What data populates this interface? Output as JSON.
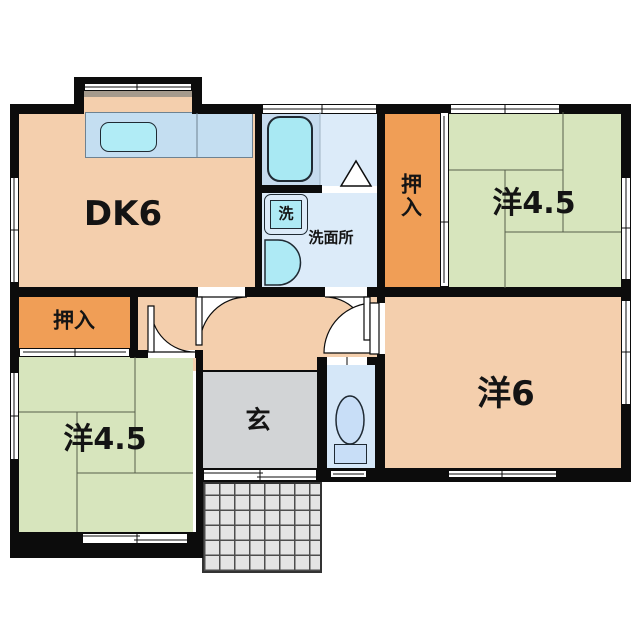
{
  "plan_title": "floor-plan",
  "palette": {
    "wall": "#0c0c0c",
    "wood_floor": "#f4cfad",
    "tatami_green": "#d7e5bd",
    "closet_orange": "#f09e56",
    "wet_blue": "#dcebf9",
    "bath_zone": "#c6dbee",
    "fixture_cyan": "#aeeaf5",
    "toilet_blue": "#d5e7f8",
    "genkan_gray": "#d2d4d6",
    "porch_gray": "#e4e4e4",
    "line": "#0c0c0c"
  },
  "rects": [
    {
      "id": "kitchen-bay-floor",
      "x": 84,
      "y": 91,
      "w": 108,
      "h": 21,
      "f": "#f4cfad"
    },
    {
      "id": "kitchen-bay-shelf",
      "x": 84,
      "y": 91,
      "w": 108,
      "h": 6,
      "f": "#a59a8c"
    },
    {
      "id": "room-dk-floor",
      "x": 19,
      "y": 112,
      "w": 236,
      "h": 175,
      "f": "#f4cfad"
    },
    {
      "id": "hallway-floor",
      "x": 138,
      "y": 297,
      "w": 239,
      "h": 74,
      "f": "#f4cfad"
    },
    {
      "id": "room-yo6-floor",
      "x": 385,
      "y": 297,
      "w": 236,
      "h": 171,
      "f": "#f4cfad"
    },
    {
      "id": "room-yo45-top-right-floor",
      "x": 449,
      "y": 112,
      "w": 172,
      "h": 176,
      "f": "#d7e5bd"
    },
    {
      "id": "room-yo45-bottom-left-floor",
      "x": 19,
      "y": 357,
      "w": 174,
      "h": 175,
      "f": "#d7e5bd"
    },
    {
      "id": "closet-top-right-floor",
      "x": 385,
      "y": 112,
      "w": 55,
      "h": 175,
      "f": "#f09e56"
    },
    {
      "id": "closet-bottom-left-floor",
      "x": 19,
      "y": 297,
      "w": 111,
      "h": 51,
      "f": "#f09e56"
    },
    {
      "id": "bathroom-floor",
      "x": 262,
      "y": 112,
      "w": 115,
      "h": 74,
      "f": "#dcebf9"
    },
    {
      "id": "bathtub-zone",
      "x": 262,
      "y": 112,
      "w": 58,
      "h": 74,
      "f": "#c6dbee"
    },
    {
      "id": "washroom-floor",
      "x": 262,
      "y": 193,
      "w": 115,
      "h": 94,
      "f": "#dcebf9"
    },
    {
      "id": "toilet-room-floor",
      "x": 327,
      "y": 357,
      "w": 48,
      "h": 111,
      "f": "#d5e7f8"
    },
    {
      "id": "genkan-floor",
      "x": 203,
      "y": 371,
      "w": 114,
      "h": 97,
      "f": "#d2d4d6"
    },
    {
      "id": "porch-tiles",
      "x": 202,
      "y": 482,
      "w": 120,
      "h": 91,
      "f": "#e4e4e4",
      "grid": 15
    },
    {
      "id": "kitchen-counter",
      "x": 85,
      "y": 112,
      "w": 168,
      "h": 46,
      "f": "#c4def1",
      "b": "1px solid #6e8291"
    },
    {
      "id": "kitchen-sink",
      "x": 100,
      "y": 122,
      "w": 57,
      "h": 30,
      "r": 9,
      "f": "#b1ecf6",
      "b": "1.5px solid #1f2a33"
    },
    {
      "id": "bathtub",
      "x": 267,
      "y": 116,
      "w": 46,
      "h": 66,
      "r": 13,
      "f": "#a9e9f3",
      "b": "2px solid #1f2a33"
    },
    {
      "id": "washing-machine",
      "x": 264,
      "y": 194,
      "w": 44,
      "h": 41,
      "r": 7,
      "f": "#dcebf9",
      "b": "1.5px solid #1f2a33"
    },
    {
      "id": "washing-machine-tub",
      "x": 270,
      "y": 200,
      "w": 32,
      "h": 29,
      "f": "#aeeaf5",
      "b": "1.5px solid #1f2a33"
    },
    {
      "id": "toilet-tank",
      "x": 334,
      "y": 444,
      "w": 33,
      "h": 20,
      "f": "#c8def7",
      "b": "1.5px solid #1f2a33"
    },
    {
      "id": "wall-top-left",
      "x": 10,
      "y": 104,
      "w": 74,
      "h": 10,
      "f": "#0c0c0c"
    },
    {
      "id": "wall-top-right",
      "x": 192,
      "y": 104,
      "w": 439,
      "h": 10,
      "f": "#0c0c0c"
    },
    {
      "id": "wall-bay-top",
      "x": 74,
      "y": 77,
      "w": 128,
      "h": 8,
      "f": "#0c0c0c"
    },
    {
      "id": "wall-bay-left",
      "x": 74,
      "y": 77,
      "w": 10,
      "h": 37,
      "f": "#0c0c0c"
    },
    {
      "id": "wall-bay-right",
      "x": 192,
      "y": 77,
      "w": 10,
      "h": 37,
      "f": "#0c0c0c"
    },
    {
      "id": "wall-left",
      "x": 10,
      "y": 104,
      "w": 9,
      "h": 454,
      "f": "#0c0c0c"
    },
    {
      "id": "wall-right",
      "x": 621,
      "y": 104,
      "w": 10,
      "h": 378,
      "f": "#0c0c0c"
    },
    {
      "id": "wall-bottom-left",
      "x": 10,
      "y": 532,
      "w": 193,
      "h": 26,
      "f": "#0c0c0c"
    },
    {
      "id": "wall-bottom-right",
      "x": 196,
      "y": 468,
      "w": 435,
      "h": 14,
      "f": "#0c0c0c"
    },
    {
      "id": "wall-porch-side",
      "x": 196,
      "y": 352,
      "w": 7,
      "h": 206,
      "f": "#0c0c0c"
    },
    {
      "id": "wall-dk-bath",
      "x": 255,
      "y": 104,
      "w": 7,
      "h": 193,
      "f": "#0c0c0c"
    },
    {
      "id": "wall-bath-washroom",
      "x": 255,
      "y": 185,
      "w": 67,
      "h": 8,
      "f": "#0c0c0c"
    },
    {
      "id": "wall-bath-closet",
      "x": 377,
      "y": 104,
      "w": 8,
      "h": 193,
      "f": "#0c0c0c"
    },
    {
      "id": "wall-mid-band",
      "x": 10,
      "y": 287,
      "w": 621,
      "h": 10,
      "f": "#0c0c0c"
    },
    {
      "id": "wall-hall-left",
      "x": 130,
      "y": 287,
      "w": 8,
      "h": 65,
      "f": "#0c0c0c"
    },
    {
      "id": "wall-hall-bottom",
      "x": 130,
      "y": 350,
      "w": 73,
      "h": 8,
      "f": "#0c0c0c"
    },
    {
      "id": "wall-toilet-left",
      "x": 317,
      "y": 357,
      "w": 10,
      "h": 111,
      "f": "#0c0c0c"
    },
    {
      "id": "wall-toilet-top",
      "x": 317,
      "y": 357,
      "w": 68,
      "h": 8,
      "f": "#0c0c0c"
    },
    {
      "id": "wall-yo6-left-upper",
      "x": 377,
      "y": 297,
      "w": 8,
      "h": 60,
      "f": "#0c0c0c"
    },
    {
      "id": "wall-yo6-left-lower",
      "x": 375,
      "y": 357,
      "w": 10,
      "h": 111,
      "f": "#0c0c0c"
    },
    {
      "id": "window-bay",
      "x": 84,
      "y": 83,
      "w": 108,
      "h": 8,
      "f": "#ffffff",
      "b": "1px solid #0c0c0c"
    },
    {
      "id": "window-top-bathroom",
      "x": 262,
      "y": 104,
      "w": 115,
      "h": 10,
      "f": "#ffffff",
      "b": "1px solid #0c0c0c"
    },
    {
      "id": "window-top-yo45",
      "x": 450,
      "y": 104,
      "w": 110,
      "h": 10,
      "f": "#ffffff",
      "b": "1px solid #0c0c0c"
    },
    {
      "id": "window-left-dk",
      "x": 10,
      "y": 177,
      "w": 9,
      "h": 106,
      "f": "#ffffff",
      "b": "1px solid #0c0c0c"
    },
    {
      "id": "window-left-yo45",
      "x": 10,
      "y": 372,
      "w": 9,
      "h": 88,
      "f": "#ffffff",
      "b": "1px solid #0c0c0c"
    },
    {
      "id": "window-right-yo45",
      "x": 621,
      "y": 177,
      "w": 10,
      "h": 103,
      "f": "#ffffff",
      "b": "1px solid #0c0c0c"
    },
    {
      "id": "window-right-yo6",
      "x": 621,
      "y": 300,
      "w": 10,
      "h": 105,
      "f": "#ffffff",
      "b": "1px solid #0c0c0c"
    },
    {
      "id": "window-bottom-yo45",
      "x": 82,
      "y": 533,
      "w": 106,
      "h": 11,
      "f": "#ffffff",
      "b": "1px solid #0c0c0c"
    },
    {
      "id": "entrance-door",
      "x": 203,
      "y": 469,
      "w": 114,
      "h": 12,
      "f": "#ffffff",
      "b": "1px solid #0c0c0c"
    },
    {
      "id": "window-bottom-toilet",
      "x": 330,
      "y": 470,
      "w": 37,
      "h": 8,
      "f": "#ffffff",
      "b": "1px solid #0c0c0c"
    },
    {
      "id": "window-bottom-yo6",
      "x": 448,
      "y": 470,
      "w": 109,
      "h": 8,
      "f": "#ffffff",
      "b": "1px solid #0c0c0c"
    },
    {
      "id": "closet-tr-sliding-door",
      "x": 440,
      "y": 112,
      "w": 9,
      "h": 175,
      "f": "#ffffff",
      "b": "1px solid #0c0c0c"
    },
    {
      "id": "closet-bl-sliding-door",
      "x": 19,
      "y": 348,
      "w": 111,
      "h": 9,
      "f": "#ffffff",
      "b": "1px solid #0c0c0c"
    },
    {
      "id": "doorway-dk",
      "x": 198,
      "y": 287,
      "w": 47,
      "h": 10,
      "f": "#ffffff"
    },
    {
      "id": "doorway-washroom",
      "x": 325,
      "y": 287,
      "w": 42,
      "h": 10,
      "f": "#ffffff"
    },
    {
      "id": "doorway-yo45",
      "x": 148,
      "y": 350,
      "w": 47,
      "h": 8,
      "f": "#ffffff"
    },
    {
      "id": "doorway-yo6",
      "x": 377,
      "y": 303,
      "w": 8,
      "h": 51,
      "f": "#ffffff"
    },
    {
      "id": "toilet-door",
      "x": 327,
      "y": 357,
      "w": 40,
      "h": 8,
      "f": "#ffffff"
    },
    {
      "id": "bathroom-door-sill",
      "x": 322,
      "y": 186,
      "w": 55,
      "h": 7,
      "f": "#ffffff"
    }
  ],
  "lines": [
    {
      "id": "tatami-tr-1",
      "x1": 449,
      "y1": 170,
      "x2": 563,
      "y2": 170,
      "c": "#57604b",
      "w": 1
    },
    {
      "id": "tatami-tr-2",
      "x1": 563,
      "y1": 112,
      "x2": 563,
      "y2": 232,
      "c": "#57604b",
      "w": 1
    },
    {
      "id": "tatami-tr-3",
      "x1": 505,
      "y1": 232,
      "x2": 621,
      "y2": 232,
      "c": "#57604b",
      "w": 1
    },
    {
      "id": "tatami-tr-4",
      "x1": 505,
      "y1": 170,
      "x2": 505,
      "y2": 288,
      "c": "#57604b",
      "w": 1
    },
    {
      "id": "tatami-bl-1",
      "x1": 19,
      "y1": 412,
      "x2": 135,
      "y2": 412,
      "c": "#57604b",
      "w": 1
    },
    {
      "id": "tatami-bl-2",
      "x1": 135,
      "y1": 357,
      "x2": 135,
      "y2": 473,
      "c": "#57604b",
      "w": 1
    },
    {
      "id": "tatami-bl-3",
      "x1": 77,
      "y1": 473,
      "x2": 193,
      "y2": 473,
      "c": "#57604b",
      "w": 1
    },
    {
      "id": "tatami-bl-4",
      "x1": 77,
      "y1": 412,
      "x2": 77,
      "y2": 532,
      "c": "#57604b",
      "w": 1
    },
    {
      "id": "window-bay-line",
      "x1": 84,
      "y1": 87,
      "x2": 192,
      "y2": 87,
      "c": "#0c0c0c",
      "w": 1
    },
    {
      "id": "window-bay-tick",
      "x1": 137,
      "y1": 83,
      "x2": 137,
      "y2": 91,
      "c": "#0c0c0c",
      "w": 1
    },
    {
      "id": "window-top-bathroom-line",
      "x1": 262,
      "y1": 109,
      "x2": 377,
      "y2": 109,
      "c": "#0c0c0c",
      "w": 1
    },
    {
      "id": "window-top-bathroom-tick",
      "x1": 322,
      "y1": 104,
      "x2": 322,
      "y2": 114,
      "c": "#0c0c0c",
      "w": 1
    },
    {
      "id": "window-top-yo45-line",
      "x1": 450,
      "y1": 109,
      "x2": 560,
      "y2": 109,
      "c": "#0c0c0c",
      "w": 1
    },
    {
      "id": "window-top-yo45-tick",
      "x1": 505,
      "y1": 104,
      "x2": 505,
      "y2": 114,
      "c": "#0c0c0c",
      "w": 1
    },
    {
      "id": "window-left-dk-line",
      "x1": 14,
      "y1": 177,
      "x2": 14,
      "y2": 283,
      "c": "#0c0c0c",
      "w": 1
    },
    {
      "id": "window-left-dk-tick",
      "x1": 10,
      "y1": 230,
      "x2": 19,
      "y2": 230,
      "c": "#0c0c0c",
      "w": 1
    },
    {
      "id": "window-left-yo45-line",
      "x1": 14,
      "y1": 372,
      "x2": 14,
      "y2": 460,
      "c": "#0c0c0c",
      "w": 1
    },
    {
      "id": "window-left-yo45-tick",
      "x1": 10,
      "y1": 416,
      "x2": 19,
      "y2": 416,
      "c": "#0c0c0c",
      "w": 1
    },
    {
      "id": "window-right-yo45-line",
      "x1": 626,
      "y1": 177,
      "x2": 626,
      "y2": 280,
      "c": "#0c0c0c",
      "w": 1
    },
    {
      "id": "window-right-yo45-tick",
      "x1": 621,
      "y1": 228,
      "x2": 631,
      "y2": 228,
      "c": "#0c0c0c",
      "w": 1
    },
    {
      "id": "window-right-yo6-line",
      "x1": 626,
      "y1": 300,
      "x2": 626,
      "y2": 405,
      "c": "#0c0c0c",
      "w": 1
    },
    {
      "id": "window-right-yo6-tick",
      "x1": 621,
      "y1": 352,
      "x2": 631,
      "y2": 352,
      "c": "#0c0c0c",
      "w": 1
    },
    {
      "id": "window-bottom-yo45-line-a",
      "x1": 82,
      "y1": 536,
      "x2": 140,
      "y2": 536,
      "c": "#0c0c0c",
      "w": 1
    },
    {
      "id": "window-bottom-yo45-line-b",
      "x1": 134,
      "y1": 540,
      "x2": 188,
      "y2": 540,
      "c": "#0c0c0c",
      "w": 1
    },
    {
      "id": "window-bottom-yo45-tick",
      "x1": 137,
      "y1": 533,
      "x2": 137,
      "y2": 544,
      "c": "#0c0c0c",
      "w": 1
    },
    {
      "id": "entrance-door-line-a",
      "x1": 203,
      "y1": 473,
      "x2": 263,
      "y2": 473,
      "c": "#0c0c0c",
      "w": 1
    },
    {
      "id": "entrance-door-line-b",
      "x1": 257,
      "y1": 477,
      "x2": 317,
      "y2": 477,
      "c": "#0c0c0c",
      "w": 1
    },
    {
      "id": "entrance-door-tick",
      "x1": 260,
      "y1": 469,
      "x2": 260,
      "y2": 481,
      "c": "#0c0c0c",
      "w": 1
    },
    {
      "id": "window-bottom-toilet-line",
      "x1": 333,
      "y1": 474,
      "x2": 364,
      "y2": 474,
      "c": "#0c0c0c",
      "w": 1
    },
    {
      "id": "window-bottom-yo6-line",
      "x1": 448,
      "y1": 474,
      "x2": 557,
      "y2": 474,
      "c": "#0c0c0c",
      "w": 1
    },
    {
      "id": "window-bottom-yo6-tick",
      "x1": 502,
      "y1": 470,
      "x2": 502,
      "y2": 478,
      "c": "#0c0c0c",
      "w": 1
    },
    {
      "id": "closet-tr-door-line",
      "x1": 444,
      "y1": 116,
      "x2": 444,
      "y2": 283,
      "c": "#0c0c0c",
      "w": 1
    },
    {
      "id": "closet-tr-door-tick",
      "x1": 440,
      "y1": 222,
      "x2": 449,
      "y2": 222,
      "c": "#0c0c0c",
      "w": 1
    },
    {
      "id": "closet-bl-door-line",
      "x1": 23,
      "y1": 352,
      "x2": 126,
      "y2": 352,
      "c": "#0c0c0c",
      "w": 1
    },
    {
      "id": "closet-bl-door-tick",
      "x1": 75,
      "y1": 348,
      "x2": 75,
      "y2": 357,
      "c": "#0c0c0c",
      "w": 1
    },
    {
      "id": "toilet-door-tick",
      "x1": 347,
      "y1": 357,
      "x2": 347,
      "y2": 365,
      "c": "#0c0c0c",
      "w": 1
    },
    {
      "id": "genkan-step-line",
      "x1": 203,
      "y1": 371,
      "x2": 317,
      "y2": 371,
      "c": "#0c0c0c",
      "w": 2
    },
    {
      "id": "counter-divider-line",
      "x1": 197,
      "y1": 113,
      "x2": 197,
      "y2": 158,
      "c": "#6e8291",
      "w": 1
    },
    {
      "id": "bathroom-zone-line",
      "x1": 320,
      "y1": 112,
      "x2": 320,
      "y2": 185,
      "c": "#9fb3c4",
      "w": 1
    }
  ],
  "paths": [
    {
      "id": "door-swing-dk",
      "d": "M200,297 L200,344 A47,47 0 0 1 247,297 Z",
      "f": "#ffffff",
      "s": "#0c0c0c",
      "w": 1.2
    },
    {
      "id": "door-swing-washroom",
      "d": "M367,297 L325,297 A42,42 0 0 1 367,339 Z",
      "f": "#ffffff",
      "s": "#0c0c0c",
      "w": 1.2
    },
    {
      "id": "door-swing-yo45",
      "d": "M151,352 L151,308 A44,44 0 0 0 195,352 Z",
      "f": "#ffffff",
      "s": "#0c0c0c",
      "w": 1.2
    },
    {
      "id": "door-swing-yo6",
      "d": "M374,353 L374,303 A50,50 0 0 0 324,353 Z",
      "f": "#ffffff",
      "s": "#0c0c0c",
      "w": 1.2
    },
    {
      "id": "door-leaf-dk",
      "d": "M196,297 h6 v48 h-6 Z",
      "f": "#ffffff",
      "s": "#0c0c0c",
      "w": 1.2
    },
    {
      "id": "door-leaf-washroom",
      "d": "M364,297 h6 v43 h-6 Z",
      "f": "#ffffff",
      "s": "#0c0c0c",
      "w": 1.2
    },
    {
      "id": "door-leaf-yo45",
      "d": "M148,306 h6 v46 h-6 Z",
      "f": "#ffffff",
      "s": "#0c0c0c",
      "w": 1.2
    },
    {
      "id": "door-leaf-yo6",
      "d": "M370,303 h9 v51 h-9 Z",
      "f": "#ffffff",
      "s": "#0c0c0c",
      "w": 1.2
    },
    {
      "id": "bathroom-folding-door",
      "d": "M341,186 L356,161 L371,186 Z",
      "f": "#ffffff",
      "s": "#0c0c0c",
      "w": 1.5
    },
    {
      "id": "washbasin",
      "d": "M265,240 L278,240 A22.5,22.5 0 0 1 278,285 L265,285 Z",
      "f": "#aeeaf5",
      "s": "#1f2a33",
      "w": 1.5
    }
  ],
  "ellipses": [
    {
      "id": "toilet-bowl",
      "cx": 350,
      "cy": 420,
      "rx": 14,
      "ry": 24,
      "f": "#c8def7",
      "s": "#1f2a33",
      "w": 1.5
    }
  ],
  "labels": [
    {
      "id": "label-dk",
      "t": "DK6",
      "x": 123,
      "y": 214,
      "fs": 34
    },
    {
      "id": "label-yo45-top-right",
      "t": "洋4.5",
      "x": 534,
      "y": 204,
      "fs": 30
    },
    {
      "id": "label-yo6",
      "t": "洋6",
      "x": 506,
      "y": 394,
      "fs": 34
    },
    {
      "id": "label-yo45-bottom-left",
      "t": "洋4.5",
      "x": 105,
      "y": 440,
      "fs": 30
    },
    {
      "id": "label-closet-top-right",
      "t": "押入",
      "x": 410,
      "y": 196,
      "fs": 21,
      "vert": true
    },
    {
      "id": "label-closet-bottom-left",
      "t": "押入",
      "x": 74,
      "y": 321,
      "fs": 21
    },
    {
      "id": "label-genkan",
      "t": "玄",
      "x": 258,
      "y": 420,
      "fs": 25
    },
    {
      "id": "label-washroom",
      "t": "洗面所",
      "x": 331,
      "y": 238,
      "fs": 15
    },
    {
      "id": "label-washer",
      "t": "洗",
      "x": 286,
      "y": 214,
      "fs": 15
    }
  ]
}
